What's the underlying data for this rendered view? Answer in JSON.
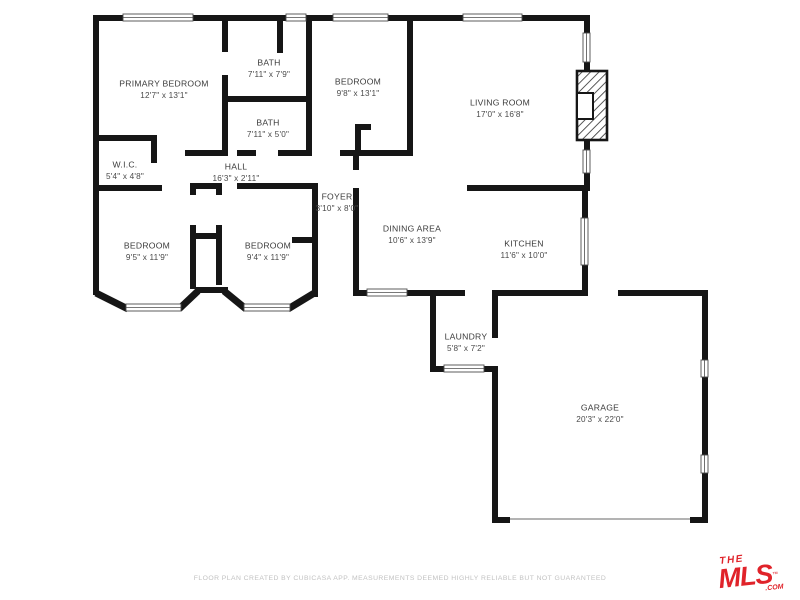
{
  "meta": {
    "width": 800,
    "height": 600,
    "background": "#ffffff"
  },
  "colors": {
    "wall": "#161616",
    "label": "#3b3b3b",
    "window_fill": "#ffffff",
    "window_stroke": "#4d4d4d",
    "garage_door": "#9a9a9a",
    "fireplace_stroke": "#161616",
    "footer_text": "#c2c2c2",
    "logo_red": "#e0232a"
  },
  "rooms": [
    {
      "name": "PRIMARY BEDROOM",
      "dims": "12'7\" x 13'1\"",
      "x": 164,
      "y": 84
    },
    {
      "name": "BATH",
      "dims": "7'11\" x 7'9\"",
      "x": 269,
      "y": 63
    },
    {
      "name": "BATH",
      "dims": "7'11\" x 5'0\"",
      "x": 268,
      "y": 123
    },
    {
      "name": "BEDROOM",
      "dims": "9'8\" x 13'1\"",
      "x": 358,
      "y": 82
    },
    {
      "name": "LIVING ROOM",
      "dims": "17'0\" x 16'8\"",
      "x": 500,
      "y": 103
    },
    {
      "name": "W.I.C.",
      "dims": "5'4\" x 4'8\"",
      "x": 125,
      "y": 165
    },
    {
      "name": "HALL",
      "dims": "16'3\" x 2'11\"",
      "x": 236,
      "y": 167
    },
    {
      "name": "FOYER",
      "dims": "3'10\" x 8'0\"",
      "x": 337,
      "y": 197
    },
    {
      "name": "BEDROOM",
      "dims": "9'5\" x 11'9\"",
      "x": 147,
      "y": 246
    },
    {
      "name": "BEDROOM",
      "dims": "9'4\" x 11'9\"",
      "x": 268,
      "y": 246
    },
    {
      "name": "DINING AREA",
      "dims": "10'6\" x 13'9\"",
      "x": 412,
      "y": 229
    },
    {
      "name": "KITCHEN",
      "dims": "11'6\" x 10'0\"",
      "x": 524,
      "y": 244
    },
    {
      "name": "LAUNDRY",
      "dims": "5'8\" x 7'2\"",
      "x": 466,
      "y": 337
    },
    {
      "name": "GARAGE",
      "dims": "20'3\" x 22'0\"",
      "x": 600,
      "y": 408
    }
  ],
  "walls": [
    [
      93,
      15,
      30,
      6
    ],
    [
      193,
      15,
      93,
      6
    ],
    [
      306,
      15,
      27,
      6
    ],
    [
      388,
      15,
      75,
      6
    ],
    [
      522,
      15,
      68,
      6
    ],
    [
      93,
      15,
      6,
      280
    ],
    [
      584,
      15,
      6,
      18
    ],
    [
      584,
      62,
      6,
      10
    ],
    [
      584,
      140,
      6,
      10
    ],
    [
      584,
      173,
      6,
      18
    ],
    [
      407,
      15,
      6,
      140
    ],
    [
      222,
      21,
      6,
      31
    ],
    [
      222,
      75,
      6,
      81
    ],
    [
      277,
      21,
      6,
      32
    ],
    [
      227,
      96,
      85,
      6
    ],
    [
      306,
      15,
      6,
      141
    ],
    [
      237,
      150,
      19,
      6
    ],
    [
      278,
      150,
      32,
      6
    ],
    [
      185,
      150,
      37,
      6
    ],
    [
      340,
      150,
      73,
      6
    ],
    [
      355,
      124,
      6,
      26
    ],
    [
      355,
      124,
      16,
      6
    ],
    [
      93,
      135,
      64,
      6
    ],
    [
      151,
      135,
      6,
      28
    ],
    [
      93,
      185,
      69,
      6
    ],
    [
      237,
      183,
      81,
      6
    ],
    [
      190,
      183,
      32,
      6
    ],
    [
      190,
      183,
      6,
      12
    ],
    [
      190,
      225,
      6,
      64
    ],
    [
      216,
      183,
      6,
      12
    ],
    [
      216,
      225,
      6,
      60
    ],
    [
      190,
      233,
      32,
      6
    ],
    [
      196,
      287,
      32,
      6
    ],
    [
      353,
      151,
      6,
      19
    ],
    [
      353,
      188,
      6,
      49
    ],
    [
      312,
      185,
      6,
      112
    ],
    [
      353,
      237,
      6,
      56
    ],
    [
      292,
      237,
      20,
      6
    ],
    [
      353,
      290,
      14,
      6
    ],
    [
      407,
      290,
      23,
      6
    ],
    [
      430,
      290,
      6,
      82
    ],
    [
      436,
      290,
      29,
      6
    ],
    [
      492,
      290,
      6,
      48
    ],
    [
      430,
      366,
      68,
      6
    ],
    [
      467,
      185,
      121,
      6
    ],
    [
      582,
      191,
      6,
      27
    ],
    [
      582,
      265,
      6,
      31
    ],
    [
      492,
      290,
      96,
      6
    ],
    [
      492,
      366,
      6,
      157
    ],
    [
      618,
      290,
      90,
      6
    ],
    [
      702,
      290,
      6,
      70
    ],
    [
      702,
      377,
      6,
      78
    ],
    [
      702,
      473,
      6,
      50
    ],
    [
      492,
      517,
      18,
      6
    ],
    [
      690,
      517,
      18,
      6
    ]
  ],
  "diagonal_walls": [
    [
      96,
      293,
      128,
      309
    ],
    [
      179,
      309,
      198,
      291
    ],
    [
      224,
      291,
      246,
      309
    ],
    [
      288,
      309,
      316,
      292
    ]
  ],
  "windows": [
    [
      123,
      14,
      70,
      7
    ],
    [
      286,
      14,
      20,
      7
    ],
    [
      333,
      14,
      55,
      7
    ],
    [
      463,
      14,
      59,
      7
    ],
    [
      126,
      304,
      55,
      7
    ],
    [
      244,
      304,
      46,
      7
    ],
    [
      367,
      289,
      40,
      7
    ],
    [
      444,
      365,
      40,
      7
    ],
    [
      583,
      33,
      7,
      29
    ],
    [
      583,
      150,
      7,
      23
    ],
    [
      581,
      218,
      7,
      47
    ],
    [
      701,
      360,
      7,
      17
    ],
    [
      701,
      455,
      7,
      18
    ]
  ],
  "garage_door": {
    "x1": 510,
    "y1": 519,
    "x2": 690,
    "y2": 519
  },
  "fireplace": {
    "x": 577,
    "y": 71,
    "w": 30,
    "h": 69,
    "inner": {
      "x": 577,
      "y": 93,
      "w": 16,
      "h": 26
    }
  },
  "footer": {
    "disclaimer": "FLOOR PLAN CREATED BY CUBICASA APP. MEASUREMENTS DEEMED HIGHLY RELIABLE BUT NOT GUARANTEED"
  },
  "logo": {
    "line1": "THE",
    "line2": "MLS",
    "tm": "™",
    "com": ".COM"
  }
}
